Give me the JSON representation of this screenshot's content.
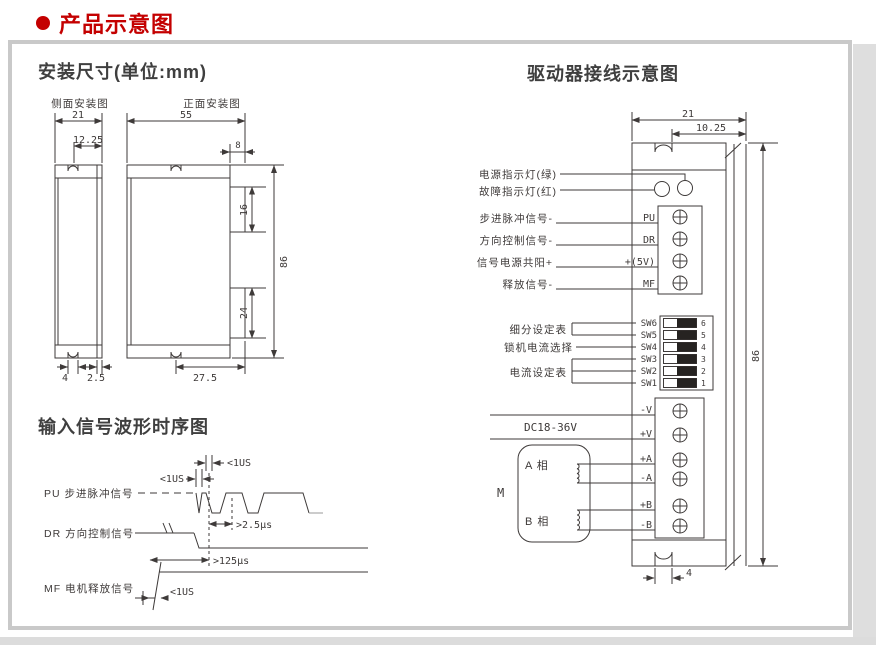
{
  "header": {
    "title": "产品示意图"
  },
  "colors": {
    "accent": "#c40000",
    "line": "#3e3a39",
    "panel_border": "#c9c9c9"
  },
  "install": {
    "title": "安装尺寸(单位:mm)",
    "side_label": "侧面安装图",
    "front_label": "正面安装图",
    "side_dims": {
      "width": "21",
      "notch_to_edge": "12.25",
      "notch_width": "4",
      "plate_thickness": "2.5"
    },
    "front_dims": {
      "width": "55",
      "tab_width": "8",
      "tab_upper": "16",
      "height": "86",
      "tab_lower": "24",
      "notch_to_edge": "27.5"
    }
  },
  "waveform": {
    "title": "输入信号波形时序图",
    "pu_label": "PU 步进脉冲信号",
    "dr_label": "DR 方向控制信号",
    "mf_label": "MF 电机释放信号",
    "ann": {
      "pu_fall": "<1US",
      "pu_rise": "<1US",
      "pu_dr_setup": ">2.5μs",
      "dr_hold": ">125μs",
      "mf_rise": "<1US"
    }
  },
  "driver": {
    "title": "驱动器接线示意图",
    "dims": {
      "width": "21",
      "notch_to_edge": "10.25",
      "height": "86",
      "notch_width": "4"
    },
    "led_power": "电源指示灯(绿)",
    "led_fault": "故障指示灯(红)",
    "signals": [
      {
        "label": "步进脉冲信号-",
        "pin": "PU"
      },
      {
        "label": "方向控制信号-",
        "pin": "DR"
      },
      {
        "label": "信号电源共阳+",
        "pin": "+(5V)"
      },
      {
        "label": "释放信号-",
        "pin": "MF"
      }
    ],
    "dip": {
      "group_subdivision": "细分设定表",
      "group_lock_current": "锁机电流选择",
      "group_current": "电流设定表",
      "switches": [
        {
          "name": "SW6",
          "num": "6"
        },
        {
          "name": "SW5",
          "num": "5"
        },
        {
          "name": "SW4",
          "num": "4"
        },
        {
          "name": "SW3",
          "num": "3"
        },
        {
          "name": "SW2",
          "num": "2"
        },
        {
          "name": "SW1",
          "num": "1"
        }
      ]
    },
    "supply": "DC18-36V",
    "power_pins": [
      "-V",
      "+V",
      "+A",
      "-A",
      "+B",
      "-B"
    ],
    "motor": {
      "label": "M",
      "phase_a": "A 相",
      "phase_b": "B 相"
    }
  }
}
